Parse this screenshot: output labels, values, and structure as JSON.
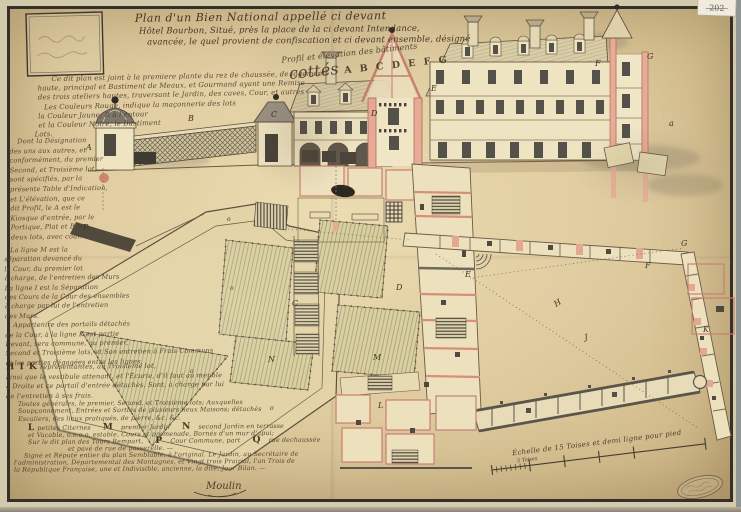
{
  "meta": {
    "archive_tag": "202"
  },
  "title": {
    "line1": "Plan d'un Bien National appellé ci devant",
    "line2": "Hôtel Bourbon, Situé, près la place de la ci devant Intendance,",
    "line3": "avancée, le quel provient de confiscation et ci devant ensemble, désigné"
  },
  "elevation": {
    "caption1": "Profil et élévation des bâtiments",
    "caption_prefix": "cottés",
    "caption_letters": "A B C D E F G",
    "labels": [
      {
        "t": "A"
      },
      {
        "t": "B"
      },
      {
        "t": "C"
      },
      {
        "t": "D"
      },
      {
        "t": "E"
      },
      {
        "t": "F"
      },
      {
        "t": "G"
      },
      {
        "t": "a"
      }
    ]
  },
  "plan": {
    "labels": [
      {
        "t": "C"
      },
      {
        "t": "D"
      },
      {
        "t": "E"
      },
      {
        "t": "F"
      },
      {
        "t": "G"
      },
      {
        "t": "H"
      },
      {
        "t": "J"
      },
      {
        "t": "K"
      },
      {
        "t": "L"
      },
      {
        "t": "M"
      },
      {
        "t": "N"
      },
      {
        "t": "P"
      },
      {
        "t": "o"
      },
      {
        "t": "o"
      },
      {
        "t": "o"
      },
      {
        "t": "o"
      }
    ]
  },
  "legend": {
    "intro": [
      "Ce dit plan est joint à la premiere plante du rez de chaussée, de logements",
      "haute, principal et Bastiment de Meaux, et Gourmand ayant une Remise",
      "des trois ateliers hautes, traversant le Jardin, des caves, Cour, et autres",
      "Les Couleurs Rouge, indique la maçonnerie des lots",
      "la Couleur Jaune, B à l'entour",
      "et la Couleur Noire, le Bastiment",
      "Lots."
    ],
    "col1": [
      "Dont la Désignation",
      "des uns aux autres, et",
      "conformément, du premier",
      "Second, et Troisième lot,",
      "sont spécifiés, par la",
      "présente Table d'Indication,",
      "et L'élévation, que ce",
      "dit Profil, le A est le",
      "Kiosque d'entrée, par le",
      "Portique, Plat et B les",
      "deux lots, avec cour."
    ],
    "col2": [
      "La ligne M est la",
      "séparation devancé du",
      "la Cour, du premier lot",
      "à charge, de l'entretien des Murs",
      "La ligne I est la Séparation",
      "des Cours de la Cour des ensembles",
      "à charge par lui de l'entretien",
      "des Murs.",
      "Appartenire des portails détachés",
      "de la Cour, à la ligne K est partie",
      "Devant, sera commune, au premier,",
      "Second et Troisième lots, et Son entretien à Frais Communs",
      "et les parties dégagées entre les lignes,"
    ],
    "hik": {
      "key": "H I K",
      "lines": [
        "représentantes, au Troisième lot,",
        "ainsi que le vestibule attenant, et l'Écurie, d'il faut au meuble",
        "à Droite et ce portail d'entrée détachés, Sont, à charge par lui",
        "de l'entretien à ses frais."
      ]
    },
    "general": [
      "Toutes générales, le premier, Second, et Troisième lots; Auxquelles",
      "Soupçonnement, Entrées et Sorties de plusieurs lieux Maisons; détachés",
      "Escaliers, des lieux pratiqués, de pierre, &c. &c."
    ],
    "lmn": {
      "l_key": "L",
      "l_text": "petites Citernes",
      "m_key": "M",
      "m_text": "premier Jardin",
      "n_key": "N",
      "n_text": "second Jardin en terrasse",
      "line2": "et Vacable, o.o.o.o. estable, Cours et promenade, Bornés d'un mur d'apui;",
      "line3a": "Sur le dit plan des Tours Rempart,",
      "p_key": "P",
      "p_text": "Cour Commune, part",
      "q_key": "Q",
      "q_text": "rue dechaussée",
      "line4": "et pavé de rue de passerelle. —"
    },
    "closing": [
      "Signé et Réputé entier du plan Semblable, à l'original. Le Jardin, au Secrétaire de",
      "l'administration, Départemental des Montagnes, et Vingt trois Prairial, l'an Trois de",
      "la République Française, une et Indivisible, ancienne, la dite, Jour Bilan. —"
    ]
  },
  "scale": {
    "caption": "Échelle de 15 Toises et demi ligne pour pied",
    "sub": "5 Toises"
  },
  "signature": "Moulin",
  "colors": {
    "paper": "#e3d0a4",
    "ink": "#4a3a28",
    "wall_pink": "#e4a892",
    "wall_gray": "#8f897c",
    "roof": "#d9cda8",
    "window": "#54504a",
    "basin": "#2b2822",
    "garden": "#d8d0a2"
  }
}
